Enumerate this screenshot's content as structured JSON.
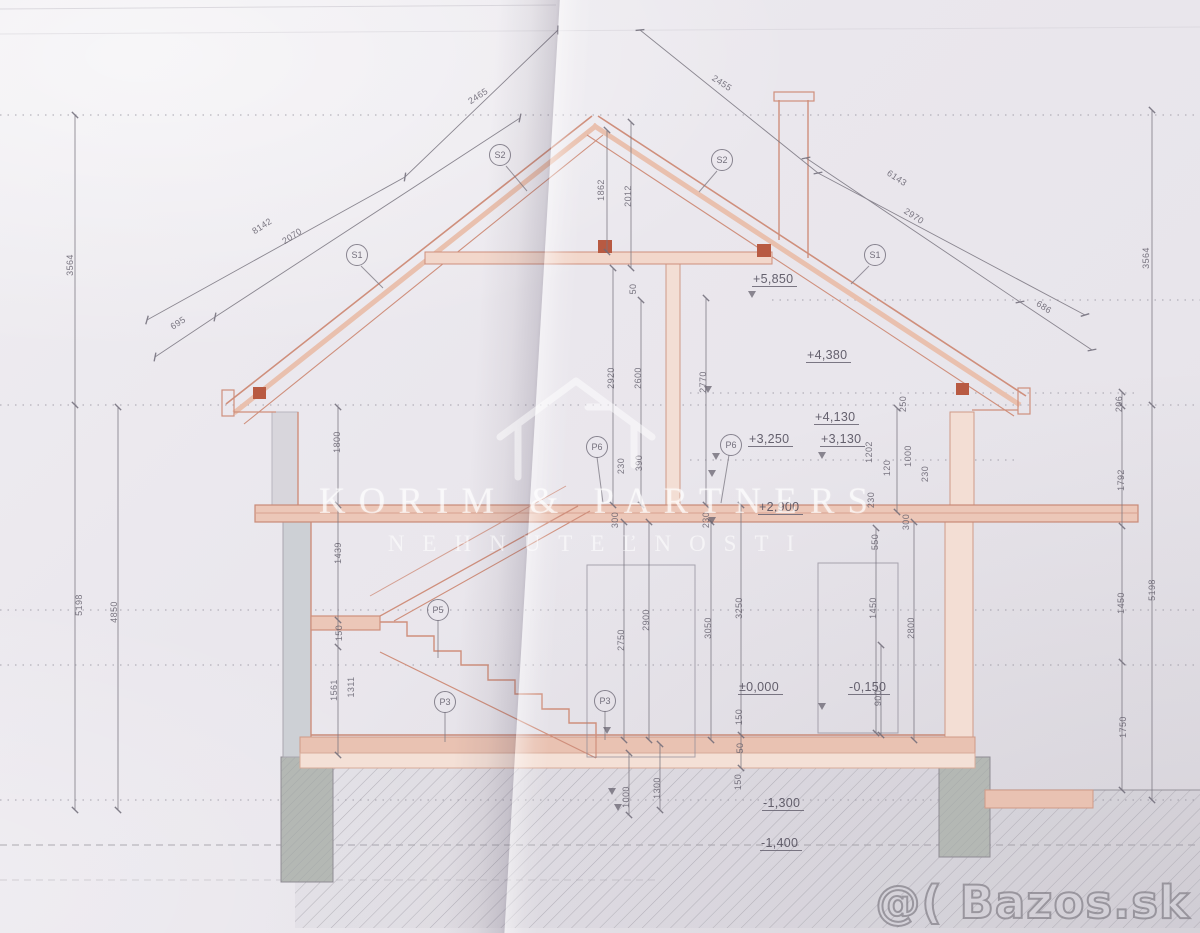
{
  "colors": {
    "paper": "#eae7ed",
    "drawing_red": "#cf8f7c",
    "drawing_red_fill": "#ecc7b8",
    "pencil_gray": "#827e8a",
    "concrete_gray": "#b4b8b4",
    "watermark_white": "rgba(255,255,255,0.6)"
  },
  "watermarks": {
    "brand_line1": "KORIM & PARTNERS",
    "brand_line2": "NEHNUTEĽNOSTI",
    "photo_service": "@( Bazos.sk"
  },
  "drawing": {
    "type": "house cross-section blueprint, scanned",
    "elevation_marks": [
      {
        "text": "+5,850",
        "x": 752,
        "y": 272
      },
      {
        "text": "+4,380",
        "x": 806,
        "y": 348
      },
      {
        "text": "+4,130",
        "x": 814,
        "y": 410
      },
      {
        "text": "+3,250",
        "x": 748,
        "y": 432
      },
      {
        "text": "+3,130",
        "x": 820,
        "y": 432
      },
      {
        "text": "+2,900",
        "x": 758,
        "y": 500
      },
      {
        "text": "±0,000",
        "x": 738,
        "y": 680
      },
      {
        "text": "-0,150",
        "x": 848,
        "y": 680
      },
      {
        "text": "-1,300",
        "x": 762,
        "y": 796
      },
      {
        "text": "-1,400",
        "x": 760,
        "y": 836
      }
    ],
    "level_triangles": [
      {
        "x": 752,
        "y": 291
      },
      {
        "x": 708,
        "y": 386
      },
      {
        "x": 716,
        "y": 453
      },
      {
        "x": 712,
        "y": 470
      },
      {
        "x": 822,
        "y": 452
      },
      {
        "x": 712,
        "y": 517
      },
      {
        "x": 607,
        "y": 727
      },
      {
        "x": 822,
        "y": 703
      },
      {
        "x": 612,
        "y": 788
      },
      {
        "x": 618,
        "y": 804
      }
    ],
    "markers": [
      {
        "label": "S2",
        "x": 500,
        "y": 155
      },
      {
        "label": "S2",
        "x": 722,
        "y": 160
      },
      {
        "label": "S1",
        "x": 357,
        "y": 255
      },
      {
        "label": "S1",
        "x": 875,
        "y": 255
      },
      {
        "label": "P6",
        "x": 597,
        "y": 447
      },
      {
        "label": "P6",
        "x": 731,
        "y": 445
      },
      {
        "label": "P5",
        "x": 438,
        "y": 610
      },
      {
        "label": "P3",
        "x": 445,
        "y": 702
      },
      {
        "label": "P3",
        "x": 605,
        "y": 701
      }
    ],
    "dim_labels": [
      {
        "t": "8142",
        "x": 262,
        "y": 226,
        "r": -33
      },
      {
        "t": "2465",
        "x": 478,
        "y": 96,
        "r": -33
      },
      {
        "t": "695",
        "x": 178,
        "y": 323,
        "r": -33
      },
      {
        "t": "2070",
        "x": 292,
        "y": 236,
        "r": -33
      },
      {
        "t": "2455",
        "x": 722,
        "y": 83,
        "r": 33
      },
      {
        "t": "6143",
        "x": 897,
        "y": 178,
        "r": 33
      },
      {
        "t": "2970",
        "x": 914,
        "y": 216,
        "r": 33
      },
      {
        "t": "686",
        "x": 1044,
        "y": 307,
        "r": 33
      },
      {
        "t": "1862",
        "x": 601,
        "y": 190,
        "r": -90
      },
      {
        "t": "2012",
        "x": 628,
        "y": 196,
        "r": -90
      },
      {
        "t": "50",
        "x": 633,
        "y": 289,
        "r": -90
      },
      {
        "t": "2920",
        "x": 611,
        "y": 378,
        "r": -90
      },
      {
        "t": "2600",
        "x": 638,
        "y": 378,
        "r": -90
      },
      {
        "t": "2770",
        "x": 703,
        "y": 382,
        "r": -90
      },
      {
        "t": "230",
        "x": 621,
        "y": 466,
        "r": -90
      },
      {
        "t": "390",
        "x": 639,
        "y": 463,
        "r": -90
      },
      {
        "t": "300",
        "x": 615,
        "y": 520,
        "r": -90
      },
      {
        "t": "230",
        "x": 706,
        "y": 520,
        "r": -90
      },
      {
        "t": "250",
        "x": 903,
        "y": 404,
        "r": -90
      },
      {
        "t": "1202",
        "x": 869,
        "y": 452,
        "r": -90
      },
      {
        "t": "1000",
        "x": 908,
        "y": 456,
        "r": -90
      },
      {
        "t": "120",
        "x": 887,
        "y": 468,
        "r": -90
      },
      {
        "t": "230",
        "x": 925,
        "y": 474,
        "r": -90
      },
      {
        "t": "230",
        "x": 871,
        "y": 500,
        "r": -90
      },
      {
        "t": "550",
        "x": 875,
        "y": 542,
        "r": -90
      },
      {
        "t": "300",
        "x": 906,
        "y": 522,
        "r": -90
      },
      {
        "t": "2750",
        "x": 621,
        "y": 640,
        "r": -90
      },
      {
        "t": "2900",
        "x": 646,
        "y": 620,
        "r": -90
      },
      {
        "t": "3050",
        "x": 708,
        "y": 628,
        "r": -90
      },
      {
        "t": "3250",
        "x": 739,
        "y": 608,
        "r": -90
      },
      {
        "t": "1450",
        "x": 873,
        "y": 608,
        "r": -90
      },
      {
        "t": "2800",
        "x": 911,
        "y": 628,
        "r": -90
      },
      {
        "t": "900",
        "x": 878,
        "y": 698,
        "r": -90
      },
      {
        "t": "150",
        "x": 739,
        "y": 717,
        "r": -90
      },
      {
        "t": "50",
        "x": 740,
        "y": 748,
        "r": -90
      },
      {
        "t": "150",
        "x": 738,
        "y": 782,
        "r": -90
      },
      {
        "t": "1000",
        "x": 626,
        "y": 797,
        "r": -90
      },
      {
        "t": "1300",
        "x": 657,
        "y": 788,
        "r": -90
      },
      {
        "t": "1800",
        "x": 337,
        "y": 442,
        "r": -90
      },
      {
        "t": "1439",
        "x": 338,
        "y": 553,
        "r": -90
      },
      {
        "t": "150",
        "x": 339,
        "y": 633,
        "r": -90
      },
      {
        "t": "1561",
        "x": 334,
        "y": 690,
        "r": -90
      },
      {
        "t": "1311",
        "x": 351,
        "y": 687,
        "r": -90
      },
      {
        "t": "3564",
        "x": 70,
        "y": 265,
        "r": -90
      },
      {
        "t": "5198",
        "x": 79,
        "y": 605,
        "r": -90
      },
      {
        "t": "4850",
        "x": 114,
        "y": 612,
        "r": -90
      },
      {
        "t": "3564",
        "x": 1146,
        "y": 258,
        "r": -90
      },
      {
        "t": "206",
        "x": 1119,
        "y": 404,
        "r": -90
      },
      {
        "t": "1792",
        "x": 1121,
        "y": 480,
        "r": -90
      },
      {
        "t": "1450",
        "x": 1121,
        "y": 603,
        "r": -90
      },
      {
        "t": "5198",
        "x": 1152,
        "y": 590,
        "r": -90
      },
      {
        "t": "1750",
        "x": 1123,
        "y": 727,
        "r": -90
      }
    ]
  }
}
